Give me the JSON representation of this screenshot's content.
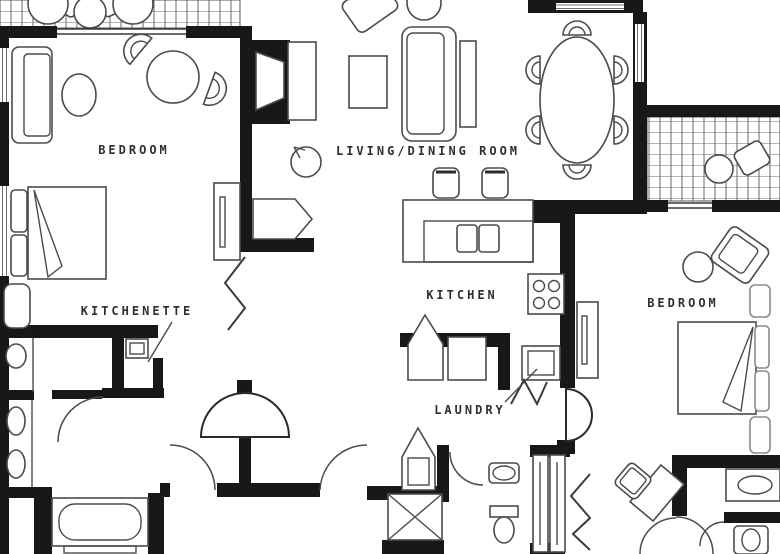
{
  "floorplan": {
    "labels": {
      "bedroom_left": "BEDROOM",
      "kitchenette": "KITCHENETTE",
      "living_dining": "LIVING/DINING ROOM",
      "kitchen": "KITCHEN",
      "laundry": "LAUNDRY",
      "bedroom_right": "BEDROOM"
    },
    "colors": {
      "wall": "#181818",
      "furniture_line": "#4b4b4b",
      "label_text": "#2f2f2f",
      "background": "#ffffff",
      "balcony_grid": "#6b6b6b"
    },
    "rooms": {
      "bedroom_left": {
        "furniture": [
          "loveseat",
          "oval-table",
          "round-table-with-chairs",
          "king-bed",
          "bench",
          "dresser"
        ]
      },
      "kitchenette": {
        "furniture": [
          "sink",
          "microwave",
          "counter"
        ]
      },
      "bathroom_left": {
        "furniture": [
          "double-sink-vanity",
          "bathtub"
        ]
      },
      "living_dining": {
        "furniture": [
          "tv-console",
          "armchair",
          "coffee-table",
          "sofa",
          "sofa-table",
          "dining-table-6-chairs",
          "plant"
        ]
      },
      "kitchen": {
        "furniture": [
          "bar-counter",
          "double-sink",
          "bar-stools",
          "stove"
        ]
      },
      "laundry": {
        "furniture": [
          "washer-dryer",
          "closet"
        ]
      },
      "bathroom_center": {
        "furniture": [
          "shower",
          "sink",
          "toilet",
          "closet"
        ]
      },
      "bedroom_right": {
        "furniture": [
          "armchair",
          "side-table",
          "dresser",
          "king-bed",
          "nightstands",
          "desk-chair"
        ]
      },
      "bathroom_right": {
        "furniture": [
          "vanity-sink",
          "toilet",
          "closet-bifold"
        ]
      },
      "balconies": {
        "furniture": [
          "patio-table",
          "patio-chairs"
        ]
      }
    }
  }
}
